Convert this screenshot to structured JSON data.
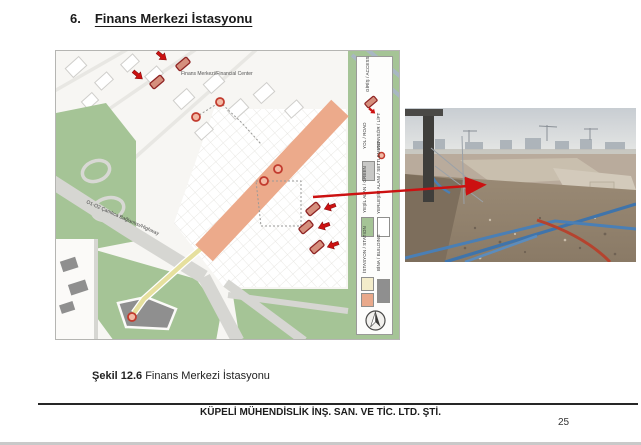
{
  "page": {
    "heading": {
      "number": "6.",
      "title": "Finans Merkezi İstasyonu"
    },
    "caption": {
      "label": "Şekil 12.6",
      "text": " Finans Merkezi İstasyonu"
    },
    "footer": {
      "company": "KÜPELİ MÜHENDİSLİK İNŞ. SAN. VE TİC. LTD. ŞTİ.",
      "page_number": "25"
    }
  },
  "map": {
    "center_label": "Finans Merkezi/Financial Center",
    "road_label": "O1-O2 Çamlıca Bağlantısı/Highway",
    "legend": {
      "items": [
        {
          "label": "GİRİŞ / ACCESS",
          "swatch": "access-marker"
        },
        {
          "label": "YOL / ROAD",
          "swatch": "#c8c8c6"
        },
        {
          "label": "ASANSÖR / LİFT",
          "swatch": "lift-circle"
        },
        {
          "label": "YEŞİL ALAN / GREEN",
          "swatch": "#a5c496"
        },
        {
          "label": "YERLEŞİM ALANI / SETTLEMENT",
          "swatch": "#ffffff"
        },
        {
          "label": "İSTASYON / STATION",
          "swatch": "#f3ecca,#e9a98b"
        },
        {
          "label": "BİNA / BUILDING",
          "swatch": "#8f8f8f"
        }
      ]
    },
    "colors": {
      "station_band": "#ecaa8b",
      "access_marker_fill": "#d58f7d",
      "access_marker_border": "#8f2424",
      "arrow_red": "#cc1111",
      "green": "#a5c496",
      "road_gray": "#d6d6d2",
      "building_dark": "#8f8f8f",
      "lift_ring": "#c23b2e"
    }
  }
}
